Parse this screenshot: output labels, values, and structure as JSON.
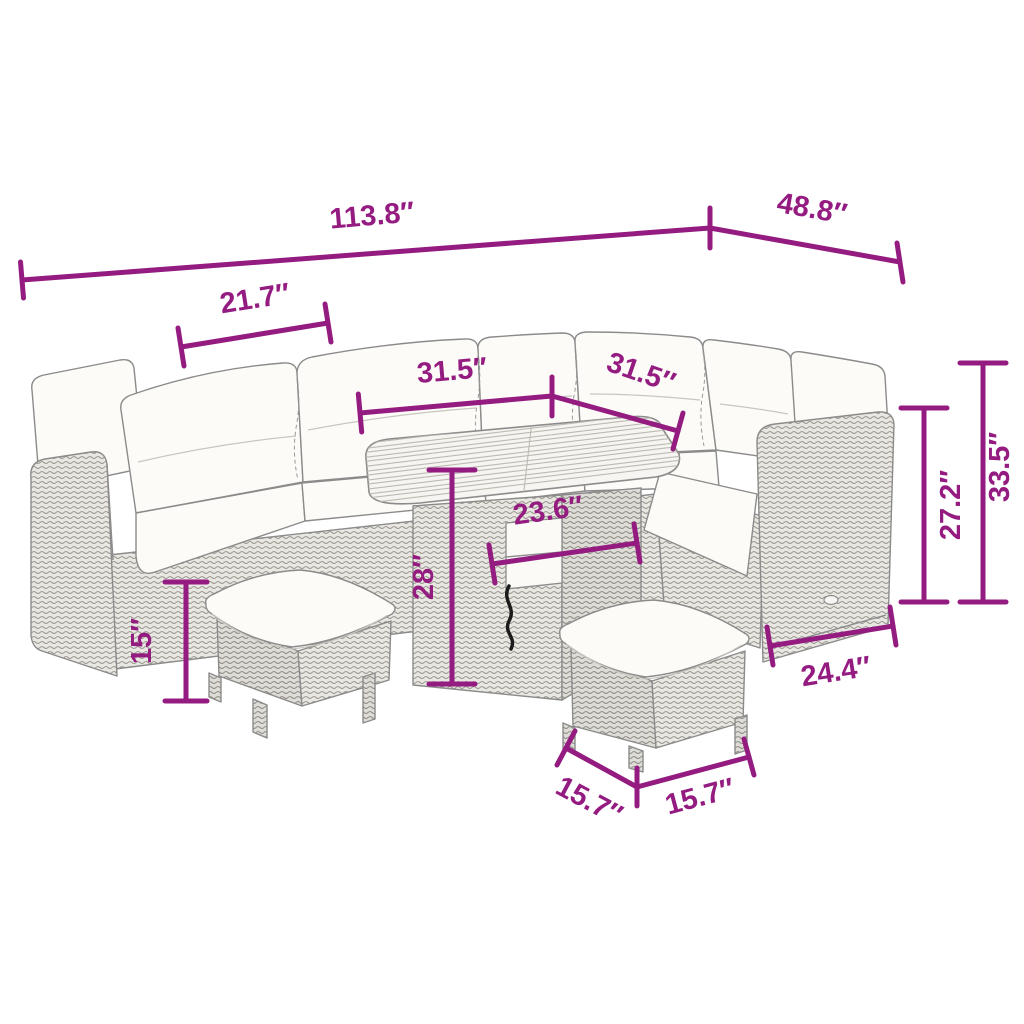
{
  "diagram": {
    "type": "product-dimension-diagram",
    "unit": "inches",
    "components": [
      "corner-sofa-with-cushions",
      "square-slat-top-table",
      "stool-left",
      "stool-right"
    ]
  },
  "measurements": {
    "overall_width": "113.8″",
    "overall_depth": "48.8″",
    "seat_width": "21.7″",
    "table_length": "31.5″",
    "table_depth": "31.5″",
    "table_base_width": "23.6″",
    "table_height": "28″",
    "stool_height": "15″",
    "backrest_height": "27.2″",
    "overall_height": "33.5″",
    "armrest_depth": "24.4″",
    "stool_width": "15.7″",
    "stool_depth": "15.7″"
  },
  "colors": {
    "dimension_accent": "#941b80",
    "outline": "#8b8b8b",
    "cushion": "#fcfbf7",
    "background": "#ffffff"
  }
}
